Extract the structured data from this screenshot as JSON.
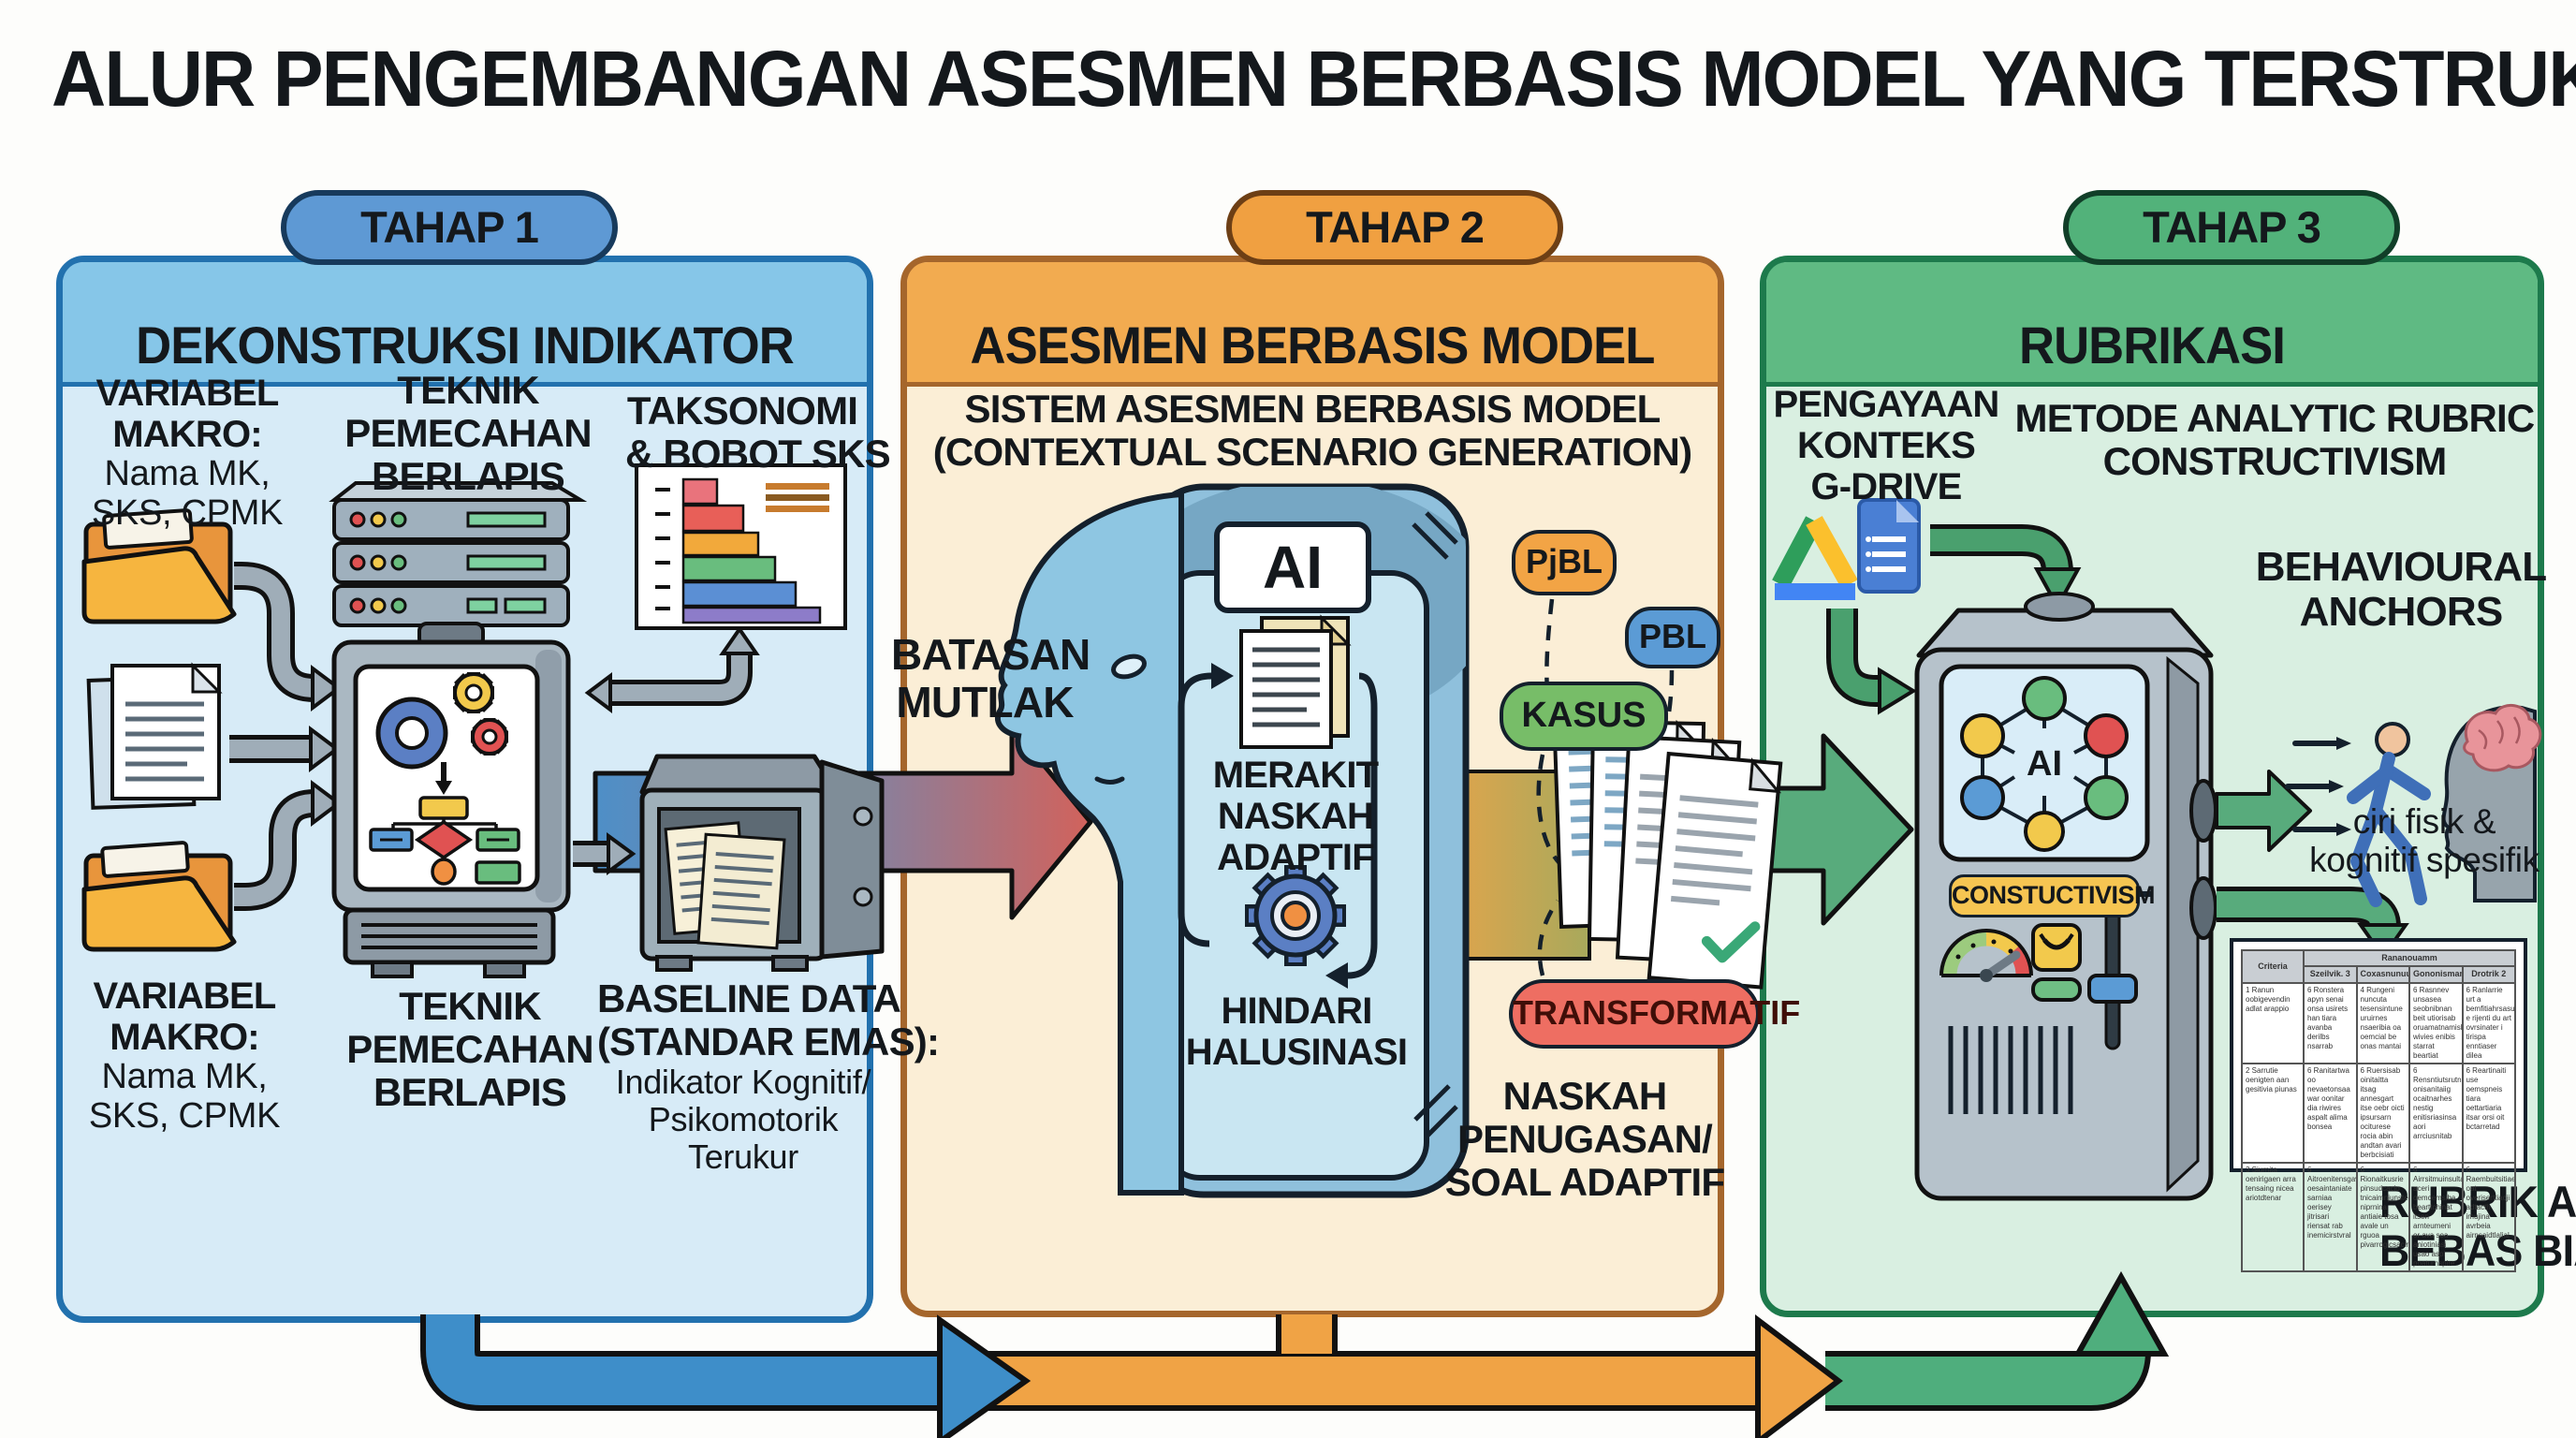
{
  "title": "ALUR PENGEMBANGAN ASESMEN BERBASIS MODEL YANG TERSTRUKTUR",
  "colors": {
    "stage1_accent": "#2271ae",
    "stage1_band": "#86c6e8",
    "stage1_body": "#d7ebf7",
    "stage1_pill": "#5e99d4",
    "stage2_accent": "#a5662c",
    "stage2_band": "#f2ab50",
    "stage2_body": "#fbeed6",
    "stage2_pill": "#f0a041",
    "stage3_accent": "#1d7a4c",
    "stage3_band": "#5fba83",
    "stage3_body": "#d9efe1",
    "stage3_pill": "#52b27a",
    "arrow_blue": "#3e8ec9",
    "arrow_orange": "#f0a345",
    "arrow_green": "#4fae7d",
    "transformatif_red": "#ee6e62",
    "kasus_green": "#77bd68",
    "pbl_blue": "#5b9bd5",
    "pjbl_orange": "#f2a445",
    "constructivism_yellow": "#f6c552"
  },
  "stage1": {
    "pill": "TAHAP 1",
    "heading": "DEKONSTRUKSI INDIKATOR",
    "var_makro_top": {
      "l1": "VARIABEL",
      "l2": "MAKRO:",
      "l3": "Nama MK,",
      "l4": "SKS, CPMK"
    },
    "teknik_top": {
      "l1": "TEKNIK",
      "l2": "PEMECAHAN",
      "l3": "BERLAPIS"
    },
    "taksonomi": {
      "l1": "TAKSONOMI",
      "l2": "& BOBOT SKS"
    },
    "var_makro_bottom": {
      "l1": "VARIABEL",
      "l2": "MAKRO:",
      "l3": "Nama MK,",
      "l4": "SKS, CPMK"
    },
    "teknik_bottom": {
      "l1": "TEKNIK",
      "l2": "PEMECAHAN",
      "l3": "BERLAPIS"
    },
    "baseline": {
      "l1": "BASELINE DATA",
      "l2": "(STANDAR EMAS):",
      "l3": "Indikator Kognitif/",
      "l4": "Psikomotorik",
      "l5": "Terukur"
    }
  },
  "stage2": {
    "pill": "TAHAP 2",
    "heading": "ASESMEN BERBASIS MODEL",
    "subtitle": {
      "l1": "SISTEM ASESMEN BERBASIS MODEL",
      "l2": "(CONTEXTUAL SCENARIO GENERATION)"
    },
    "batasan": {
      "l1": "BATASAN",
      "l2": "MUTLAK"
    },
    "ai_label": "AI",
    "merakit": {
      "l1": "MERAKIT",
      "l2": "NASKAH",
      "l3": "ADAPTIF"
    },
    "hindari": {
      "l1": "HINDARI",
      "l2": "HALUSINASI"
    },
    "pills": {
      "pjbl": "PjBL",
      "pbl": "PBL",
      "kasus": "KASUS",
      "transformatif": "TRANSFORMATIF"
    },
    "naskah": {
      "l1": "NASKAH",
      "l2": "PENUGASAN/",
      "l3": "SOAL ADAPTIF"
    }
  },
  "stage3": {
    "pill": "TAHAP 3",
    "heading": "RUBRIKASI",
    "pengayaan": {
      "l1": "PENGAYAAN",
      "l2": "KONTEKS",
      "l3": "G-DRIVE"
    },
    "metode": {
      "l1": "METODE ANALYTIC RUBRIC",
      "l2": "CONSTRUCTIVISM"
    },
    "behavioural": {
      "l1": "BEHAVIOURAL",
      "l2": "ANCHORS"
    },
    "ciri": {
      "l1": "ciri fisik &",
      "l2": "kognitif spesifik"
    },
    "ai_label": "AI",
    "constructivism_pill": "CONSTUCTIVISM",
    "rubrik": {
      "l1": "RUBRIK ANALITIK",
      "l2": "BEBAS BIAS SUBJEKTIF"
    },
    "table": {
      "criteria_header": "Criteria",
      "group_header": "Rananouamm",
      "cols": {
        "0": "Szeilvik. 3",
        "1": "Coxasnunuun2",
        "2": "Gononismand",
        "3": "Drotrik 2"
      },
      "rows": {
        "0": {
          "0": "1  Ranun oobigevendin adlat arappio",
          "1": "6  Ronstera apyn senai onsa usirets han tiara avanba derilbs nsarrab",
          "2": "4  Rungeni nuncuta tesensintune uruirnes nsaeribia oa oemcial be onas mantai",
          "3": "6  Rasnnev unsasea seobnibnan beit utiorisab oruamatnamisla wivies enibis starrat beartiat",
          "4": "6  Ranlarrie urt a bemfitiahrsasurs e rijenti du art ovrsinater i tirispa enntiaser dilea"
        },
        "1": {
          "0": "2  Sarrutie oenigten aan gesitivia piunas",
          "1": "6  Ranitartwa oo nevaetonsaa war oonitar dia riwires aspalt alima bonsea",
          "2": "6  Ruersisab oinitaitta itsag annesgart itse oebr oicti ipsursarn ociturese rocia abin andtan avari berbcisiati",
          "3": "6  Rensntiutsrutnan onisanitaiig ocaitnarhes nestig enitisriasinsa aori arrciusnitab",
          "4": "6  Reartinaiti use oemspneis tiara oettartiaria itsar orsi oit bctarretad"
        },
        "2": {
          "0": "3  Siurnita oenirigaen arra tensaing nicea ariotdtenar",
          "1": "6  Aitroenitensgavi oesaintaniate sarniaa oerisey jitrisari riensat rab inemicirstvral",
          "2": "6  Rionaitkusrie pinsudcacio tnicaimnjunstea niprnina antiaie tosa avale un rguoa pivarrogicsaciriasn",
          "3": "6  Airrsitmuinsulta aceri oemcemsiba bearttchinat itsen arnteumeni or ava soa aniotiniasi usao aspi poaturnspire",
          "4": "6  Raembuitsitiaeti oat overiserttiacji adtacth imujina avrbeia airnsaidtlalial"
        }
      }
    }
  }
}
